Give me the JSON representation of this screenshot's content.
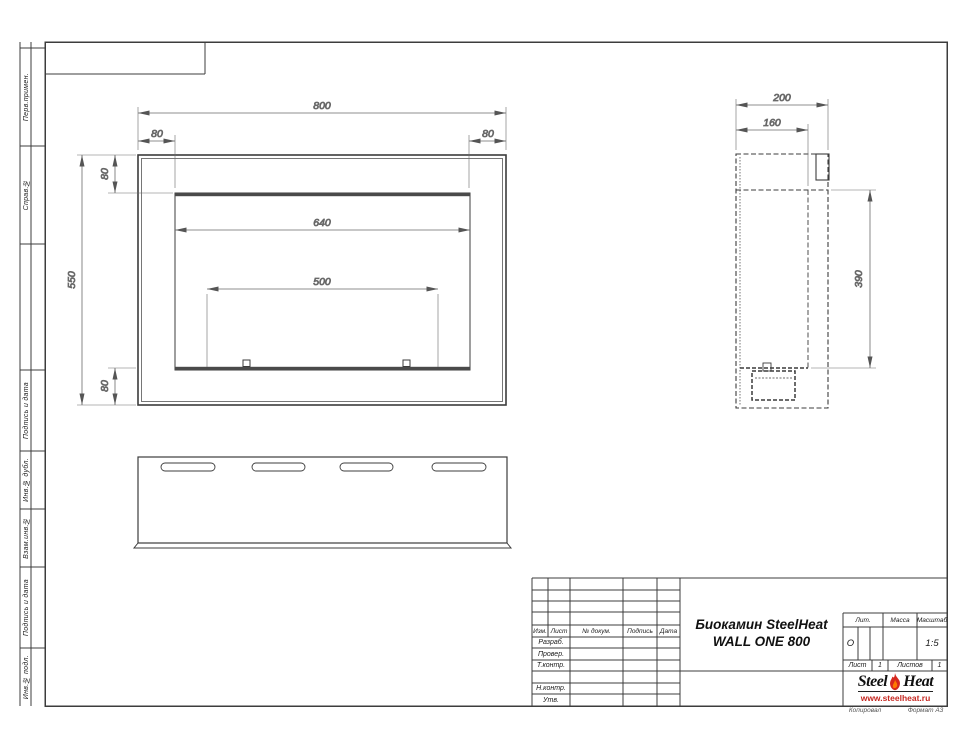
{
  "sidebar": {
    "cells": [
      {
        "label": "Перв.примен."
      },
      {
        "label": "Справ.№"
      },
      {
        "label": "Подпись и дата"
      },
      {
        "label": "Инв.№ дубл."
      },
      {
        "label": "Взам.инв.№"
      },
      {
        "label": "Подпись и дата"
      },
      {
        "label": "Инв.№ подл."
      }
    ]
  },
  "title_block": {
    "header_cols": [
      "Изм.",
      "Лист",
      "№ докум.",
      "Подпись",
      "Дата"
    ],
    "approval_rows": [
      "Разраб.",
      "Провер.",
      "Т.контр.",
      "",
      "Н.контр.",
      "Утв."
    ],
    "title_line1": "Биокамин SteelHeat",
    "title_line2": "WALL ONE 800",
    "lit_label": "Лит.",
    "lit_value": "О",
    "mass_label": "Масса",
    "scale_label": "Масштаб",
    "scale_value": "1:5",
    "sheet_label": "Лист",
    "sheet_value": "1",
    "sheets_label": "Листов",
    "sheets_value": "1",
    "logo_steel": "Steel",
    "logo_heat": "Heat",
    "logo_site": "www.steelheat.ru",
    "footer_copy": "Копировал",
    "footer_format": "Формат А3"
  },
  "dimensions": {
    "front": {
      "width": "800",
      "inset_left": "80",
      "inset_right": "80",
      "inset_top": "80",
      "height": "550",
      "inset_bottom": "80",
      "opening_width": "640",
      "burner_width": "500"
    },
    "side": {
      "depth": "200",
      "inner_depth": "160",
      "opening_height": "390"
    }
  },
  "colors": {
    "line": "#3c3c3c",
    "dim": "#6a6a6a",
    "flame_red": "#d6281e",
    "flame_orange": "#ff7a00"
  }
}
